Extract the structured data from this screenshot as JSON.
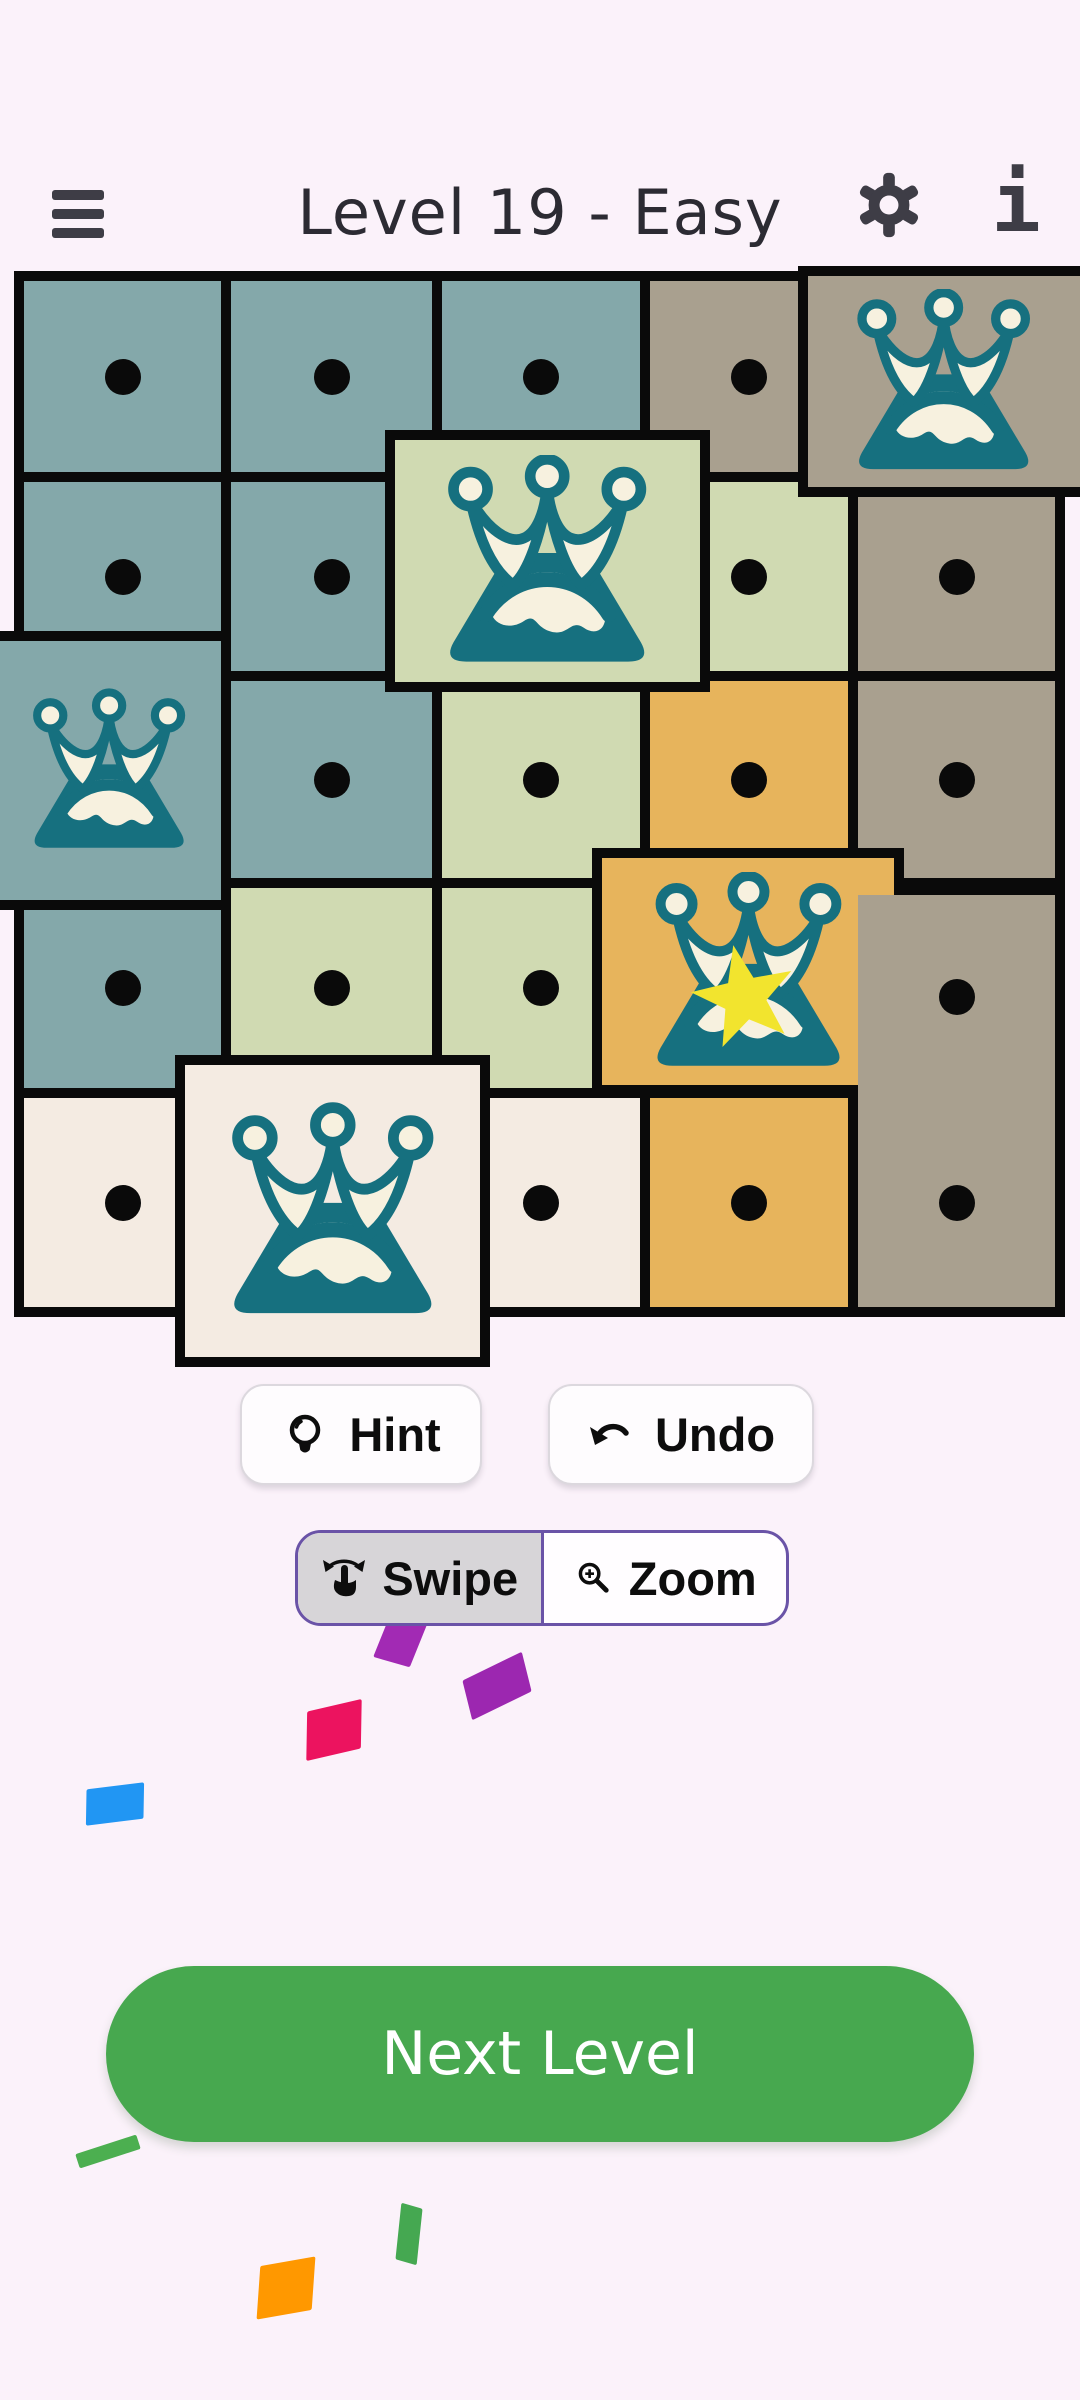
{
  "header": {
    "title": "Level 19 - Easy"
  },
  "icons": {
    "menu": "hamburger",
    "settings": "gear",
    "info": "letter-i",
    "hint": "lightbulb",
    "undo": "curved-arrow-left",
    "swipe": "swipe-hand",
    "zoom": "magnifier-plus",
    "cell_marker": "black-dot",
    "queen": "crown-mountain",
    "queen_star": "crown-mountain-star"
  },
  "controls": {
    "hint": "Hint",
    "undo": "Undo",
    "swipe": "Swipe",
    "zoom": "Zoom",
    "selected_mode": "Swipe",
    "next_level": "Next Level"
  },
  "colors": {
    "page_bg": "#fbf2fa",
    "title_color": "#2c2b33",
    "icon_dark": "#3e3d46",
    "board_line": "#0a0a0a",
    "teal": "#84a8aa",
    "sage": "#d0dab2",
    "taupe": "#a9a08f",
    "orange": "#e7b45c",
    "cream": "#f4ebe2",
    "crown_teal": "#16707f",
    "crown_cream": "#f7f1df",
    "star_yellow": "#f2e42e",
    "accent_purple": "#6a53a7",
    "toggle_selected": "#d7d5d8",
    "green_button": "#47a84f"
  },
  "grid": {
    "rows": 5,
    "cols": 5,
    "cells": [
      {
        "r": 0,
        "c": 0,
        "color": "teal",
        "state": "dot"
      },
      {
        "r": 0,
        "c": 1,
        "color": "teal",
        "state": "dot"
      },
      {
        "r": 0,
        "c": 2,
        "color": "teal",
        "state": "dot"
      },
      {
        "r": 0,
        "c": 3,
        "color": "taupe",
        "state": "dot"
      },
      {
        "r": 0,
        "c": 4,
        "color": "taupe",
        "state": "crown",
        "raised": true
      },
      {
        "r": 1,
        "c": 0,
        "color": "teal",
        "state": "dot"
      },
      {
        "r": 1,
        "c": 1,
        "color": "teal",
        "state": "dot"
      },
      {
        "r": 1,
        "c": 2,
        "color": "sage",
        "state": "crown",
        "raised": true
      },
      {
        "r": 1,
        "c": 3,
        "color": "sage",
        "state": "dot"
      },
      {
        "r": 1,
        "c": 4,
        "color": "taupe",
        "state": "dot"
      },
      {
        "r": 2,
        "c": 0,
        "color": "teal",
        "state": "crown",
        "raised": true
      },
      {
        "r": 2,
        "c": 1,
        "color": "teal",
        "state": "dot"
      },
      {
        "r": 2,
        "c": 2,
        "color": "sage",
        "state": "dot"
      },
      {
        "r": 2,
        "c": 3,
        "color": "orange",
        "state": "dot"
      },
      {
        "r": 2,
        "c": 4,
        "color": "taupe",
        "state": "dot"
      },
      {
        "r": 3,
        "c": 0,
        "color": "teal",
        "state": "dot"
      },
      {
        "r": 3,
        "c": 1,
        "color": "sage",
        "state": "dot"
      },
      {
        "r": 3,
        "c": 2,
        "color": "sage",
        "state": "dot"
      },
      {
        "r": 3,
        "c": 3,
        "color": "orange",
        "state": "crown_star",
        "raised": true
      },
      {
        "r": 3,
        "c": 4,
        "color": "taupe",
        "state": "dot"
      },
      {
        "r": 4,
        "c": 0,
        "color": "cream",
        "state": "dot"
      },
      {
        "r": 4,
        "c": 1,
        "color": "cream",
        "state": "crown",
        "raised": true
      },
      {
        "r": 4,
        "c": 2,
        "color": "cream",
        "state": "dot"
      },
      {
        "r": 4,
        "c": 3,
        "color": "orange",
        "state": "dot"
      },
      {
        "r": 4,
        "c": 4,
        "color": "taupe",
        "state": "dot"
      }
    ]
  },
  "confetti": [
    {
      "color": "#a22ab4",
      "x": 383,
      "y": 1608,
      "w": 38,
      "h": 56,
      "rot": 16,
      "skew": -6
    },
    {
      "color": "#9c27b0",
      "x": 464,
      "y": 1666,
      "w": 66,
      "h": 40,
      "rot": -26,
      "skew": -12
    },
    {
      "color": "#ec135f",
      "x": 306,
      "y": 1706,
      "w": 56,
      "h": 48,
      "rot": -13,
      "skew": -14
    },
    {
      "color": "#2196f3",
      "x": 86,
      "y": 1786,
      "w": 58,
      "h": 36,
      "rot": -7,
      "skew": -8
    },
    {
      "color": "#4caf50",
      "x": 76,
      "y": 2144,
      "w": 64,
      "h": 15,
      "rot": -18,
      "skew": 0
    },
    {
      "color": "#45a851",
      "x": 398,
      "y": 2206,
      "w": 22,
      "h": 56,
      "rot": 16,
      "skew": 10
    },
    {
      "color": "#ff9800",
      "x": 258,
      "y": 2262,
      "w": 56,
      "h": 52,
      "rot": -10,
      "skew": -14
    }
  ]
}
